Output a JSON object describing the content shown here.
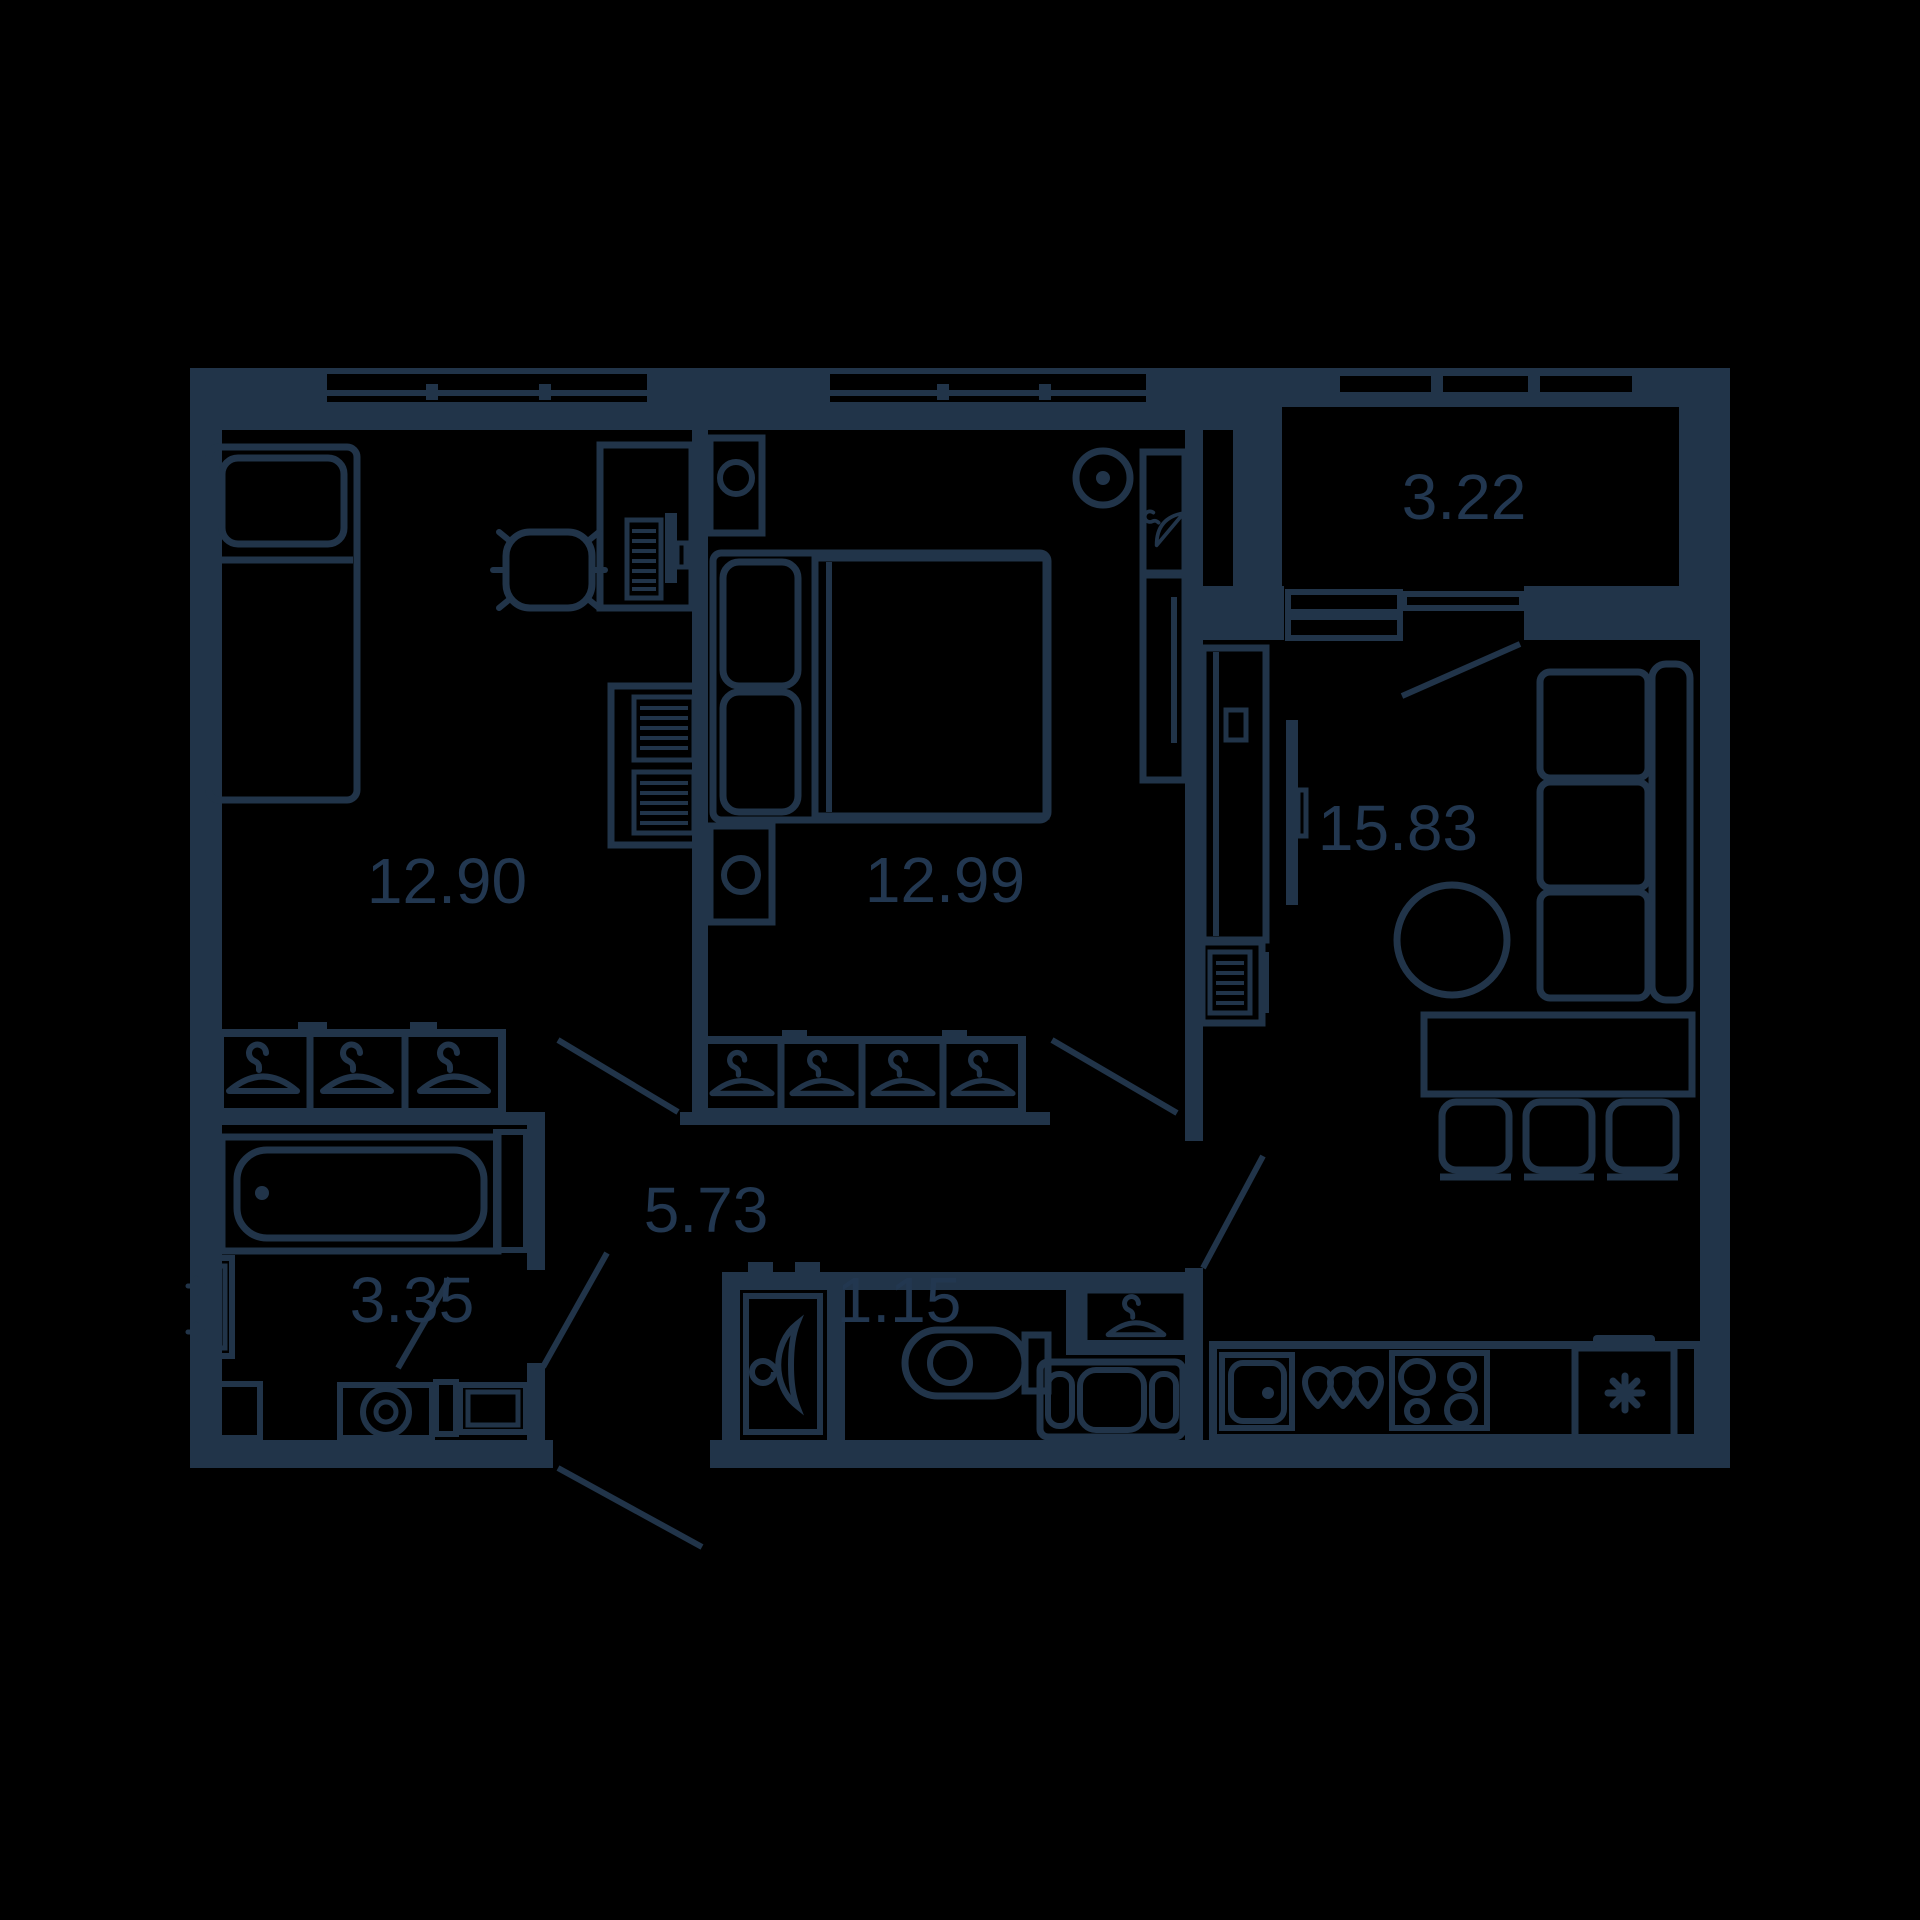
{
  "plan": {
    "type": "apartment-floor-plan",
    "colors": {
      "background": "#000000",
      "ink": "#213449"
    },
    "rooms": [
      {
        "id": "bedroom-1",
        "area": "12.90"
      },
      {
        "id": "bedroom-2",
        "area": "12.99"
      },
      {
        "id": "living-kitchen",
        "area": "15.83"
      },
      {
        "id": "balcony",
        "area": "3.22"
      },
      {
        "id": "hallway",
        "area": "5.73"
      },
      {
        "id": "bathroom",
        "area": "3.35"
      },
      {
        "id": "wc",
        "area": "1.15"
      }
    ]
  }
}
